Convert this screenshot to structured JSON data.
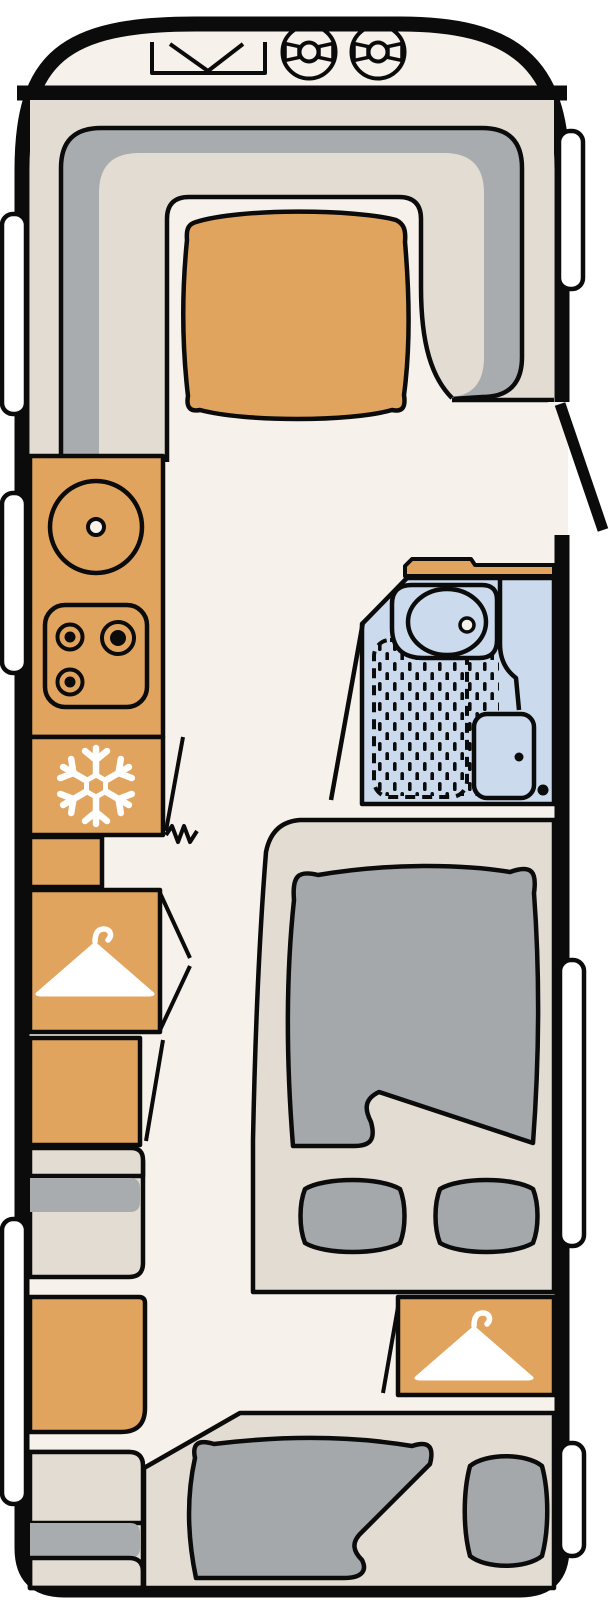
{
  "meta": {
    "kind": "caravan-floor-plan",
    "orientation": "top-down, hitch at top",
    "canvas": {
      "width": 609,
      "height": 1600
    }
  },
  "palette": {
    "page": "#FFFFFF",
    "floor": "#F6F1EB",
    "beige": "#E3DCD2",
    "grayseat": "#A9ACAE",
    "graybed": "#A4A8AA",
    "orange": "#E1A45E",
    "blue": "#CBDAED",
    "white": "#FFFFFF",
    "line": "#0B0B0B"
  },
  "icons": [
    "hitch-icon",
    "gas-bottle-icon",
    "sink-icon",
    "hob-burner-icon",
    "snowflake-icon",
    "hanger-icon",
    "washbasin-icon",
    "shower-icon",
    "toilet-icon",
    "window-icon",
    "door-leaf-icon",
    "zigzag-step-icon"
  ],
  "features": {
    "front_storage": [
      "hitch-marker",
      "gas-bottle",
      "gas-bottle"
    ],
    "lounge": [
      "u-shaped-seat",
      "table"
    ],
    "kitchen": [
      "counter",
      "sink",
      "hob-3-burners",
      "fridge",
      "side-counter"
    ],
    "storage_left": [
      "wardrobe",
      "cabinet",
      "side-seat",
      "cabinet",
      "side-seat"
    ],
    "bathroom": [
      "counter",
      "washbasin",
      "shower",
      "toilet"
    ],
    "bedroom_mid": [
      "bed",
      "duvet",
      "pillow",
      "pillow",
      "wardrobe"
    ],
    "bedroom_rear": [
      "bed",
      "duvet",
      "pillow"
    ],
    "openings": [
      "entry-door",
      "window-left x3",
      "window-right x3"
    ]
  }
}
